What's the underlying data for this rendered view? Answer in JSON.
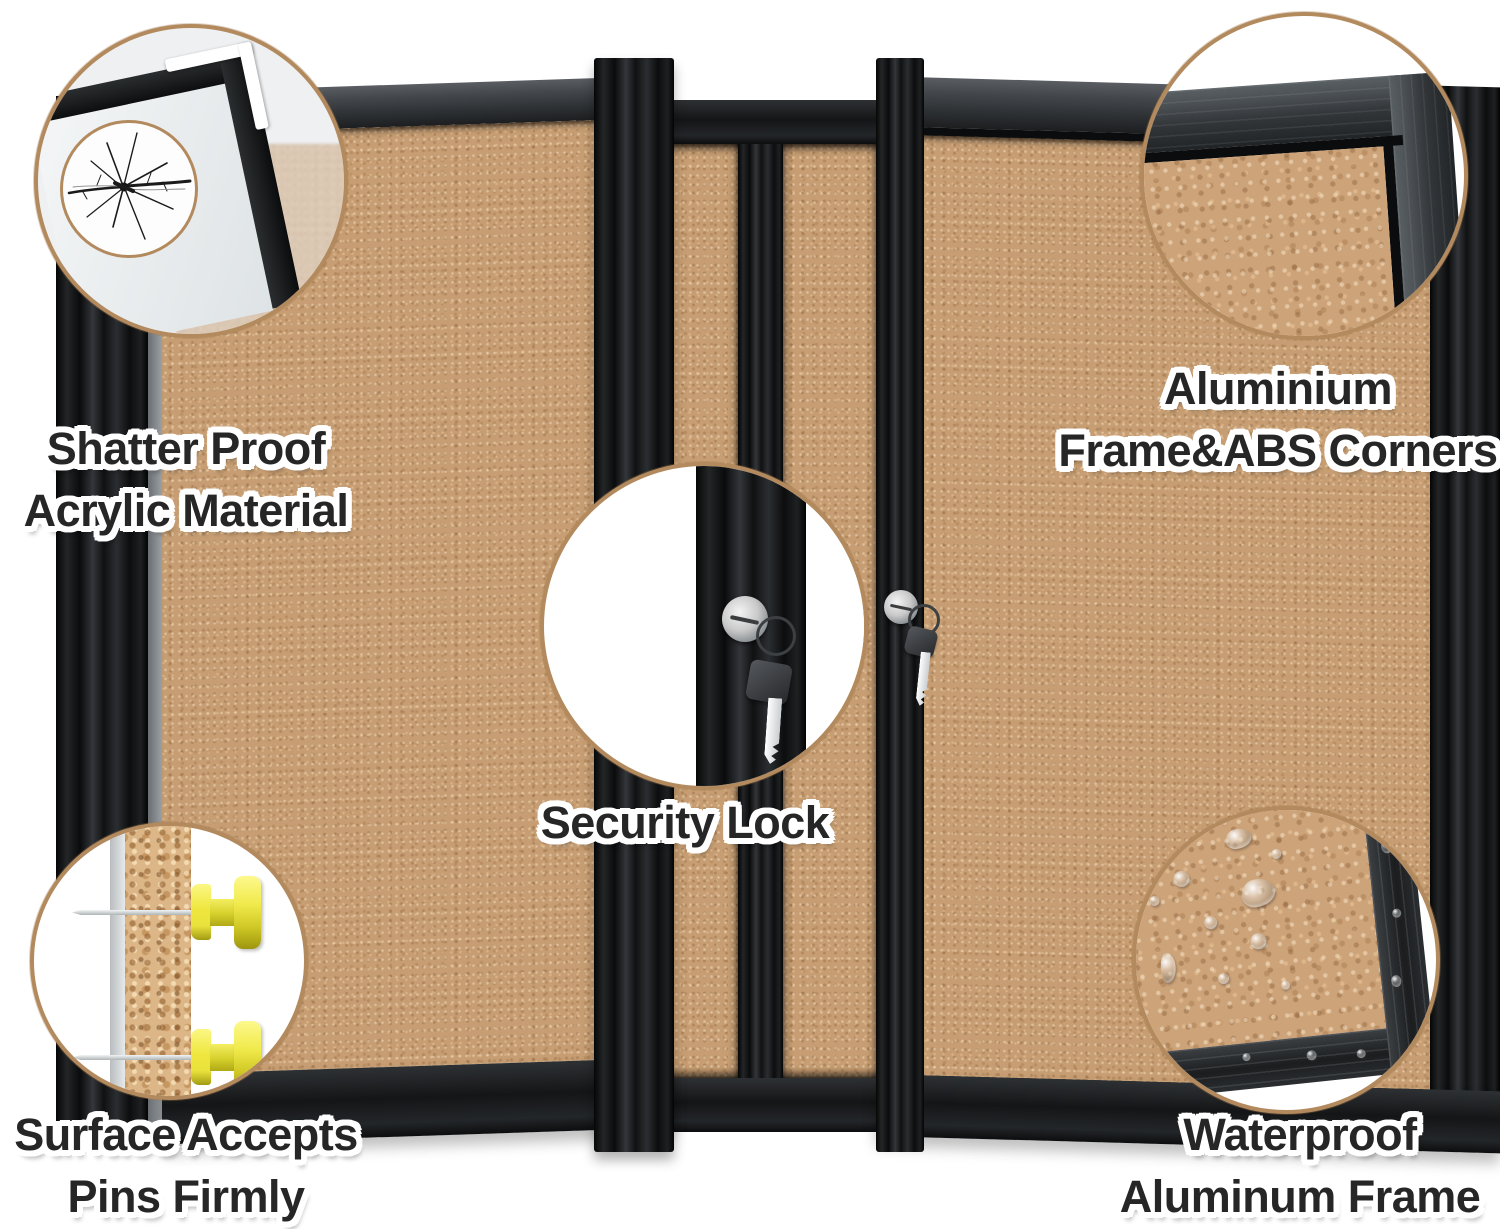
{
  "features": {
    "shatter_proof": {
      "line1": "Shatter Proof",
      "line2": "Acrylic Material",
      "icon": "crack-icon"
    },
    "aluminium_corners": {
      "line1": "Aluminium",
      "line2": "Frame&ABS Corners",
      "icon": "frame-corner-icon"
    },
    "security_lock": {
      "line1": "Security Lock",
      "icon": "lock-and-key-icon"
    },
    "pin_surface": {
      "line1": "Surface Accepts",
      "line2": "Pins Firmly",
      "icon": "pushpin-icon"
    },
    "waterproof": {
      "line1": "Waterproof",
      "line2": "Aluminum Frame",
      "icon": "water-drops-icon"
    }
  },
  "colors": {
    "bg": "#ffffff",
    "cork": "#c79e73",
    "cork_deep": "#cda379",
    "granule": "#dcb687",
    "frame_black": "#17181a",
    "frame_gray": "#43474b",
    "callout_border": "#b38a5e",
    "pin_yellow": "#e9e23c",
    "lock_silver": "#8a9094",
    "key_black": "#26282b",
    "text_color": "#262626",
    "text_outline": "#ffffff"
  }
}
